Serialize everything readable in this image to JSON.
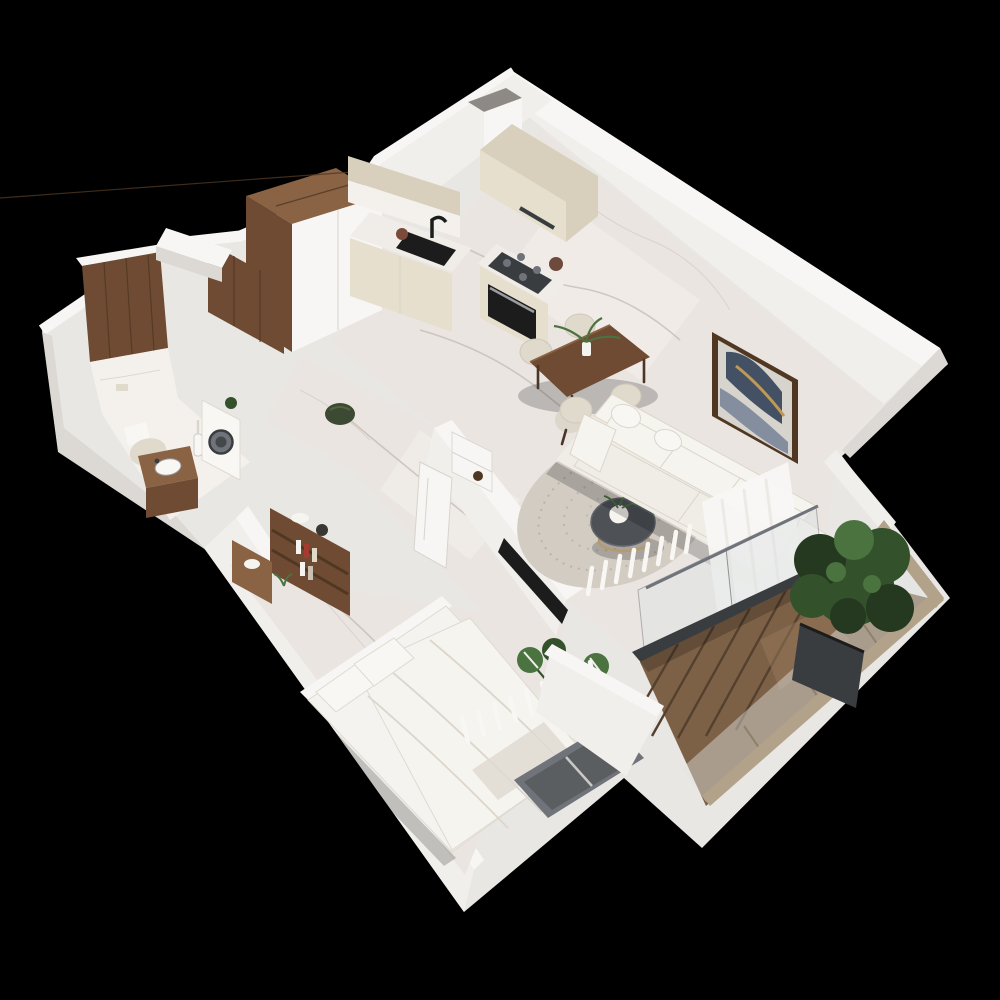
{
  "meta": {
    "title": "3D isometric cutaway floor plan of a one-bedroom apartment",
    "style": "photorealistic top-down axonometric render on black background",
    "background": "#000000"
  },
  "colors": {
    "bg": "#000000",
    "wall_top": "#f7f6f4",
    "wall_bright": "#f1efec",
    "wall_light": "#e9e7e3",
    "wall_mid": "#dcd9d4",
    "wall_dim": "#ccc8c2",
    "floor_marble": "#eae5e1",
    "floor_bright": "#f4f1ed",
    "cream": "#e6dfce",
    "cream_dark": "#d8d0bc",
    "counter_top": "#f0ece7",
    "walnut": "#6e4b32",
    "walnut_dark": "#503722",
    "walnut_light": "#8a6244",
    "black_appliance": "#1c1c1c",
    "steel_dark": "#3a3d40",
    "steel_mid": "#70747a",
    "window_glass": "#5b5e60",
    "deck": "#7c6147",
    "deck_light": "#97795a",
    "sofa": "#f0ede6",
    "sofa_shade": "#dcd6cb",
    "cushion": "#f6f4ef",
    "rug": "#d3ccc3",
    "rug_speckle": "#b5ada2",
    "table_dark": "#4e5257",
    "gold": "#b59b6b",
    "chair": "#e0dacd",
    "plant_dark": "#24391f",
    "plant": "#33512b",
    "plant_light": "#4a7340",
    "bed_linen": "#f5f3ef",
    "linen_shade": "#dfdad1",
    "art_bg": "#d7d4ce",
    "art_navy": "#37455c",
    "art_slate": "#7b8699",
    "art_gold": "#c09a55",
    "glass": "#dfe4e3",
    "rail_tan": "#b2a289",
    "curtain": "#f8f7f4",
    "pouf_green": "#3d4a33",
    "shadow": "rgba(0,0,0,0.20)"
  },
  "rooms": [
    {
      "id": "kitchen-dining",
      "label": "Kitchen and dining area",
      "items": [
        "cream kitchen cabinets",
        "marble countertop and backsplash",
        "black undermount sink with tall black faucet",
        "amber glass vase",
        "gas hob with four burners",
        "built-in oven",
        "cream hood cabinet",
        "ventilation shaft",
        "tall walnut wardrobe",
        "walnut dining table",
        "four beige upholstered dining chairs",
        "white vase with green sprigs"
      ]
    },
    {
      "id": "living",
      "label": "Living area",
      "items": [
        "white three-seat sofa with back cushions and pillows",
        "round charcoal coffee table with gold wire base",
        "round speckled area rug",
        "framed abstract wall art in walnut frame",
        "sheer white curtains",
        "dark-framed glass sliding door to balcony"
      ]
    },
    {
      "id": "bedroom",
      "label": "Bedroom",
      "items": [
        "double bed with white bedding and two pillows",
        "walnut wall shelf with books and decor",
        "walnut desk with white decor",
        "TV mounted on partition wall",
        "monstera plant in pot",
        "exterior window with sheer curtain"
      ]
    },
    {
      "id": "bathroom",
      "label": "Bathroom",
      "items": [
        "walnut slatted accent wall",
        "marble tile wainscot",
        "toilet with beige lid",
        "walnut vanity with white basin",
        "washing machine with round door",
        "toilet brush",
        "small green plant"
      ]
    },
    {
      "id": "hallway",
      "label": "Entrance hall",
      "items": [
        "walnut wardrobe panel",
        "white storage niche with dark bowl",
        "open white interior door",
        "dark green pouf"
      ]
    },
    {
      "id": "balcony",
      "label": "Balcony",
      "items": [
        "hardwood deck boards",
        "glass balustrade with tan handrail",
        "large potted shrub in charcoal planter"
      ]
    }
  ]
}
